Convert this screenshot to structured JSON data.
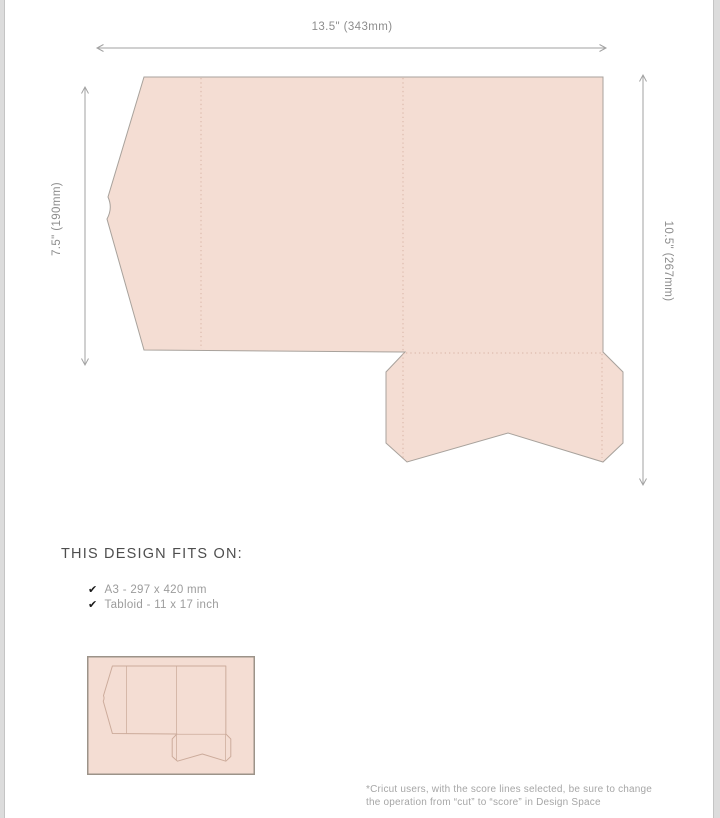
{
  "dimensions": {
    "top": "13.5\" (343mm)",
    "left": "7.5\" (190mm)",
    "right": "10.5\" (267mm)"
  },
  "fits_on": {
    "heading": "THIS DESIGN FITS ON:",
    "checkmark_glyph": "✔",
    "items": [
      {
        "icon": "checkmark",
        "label": "A3 - 297 x 420 mm"
      },
      {
        "icon": "checkmark",
        "label": "Tabloid - 11 x 17 inch"
      }
    ]
  },
  "footnote": {
    "line1": "*Cricut users, with the score lines selected, be sure to change",
    "line2": "the operation from “cut” to “score” in Design Space"
  },
  "colors": {
    "shape-fill": "#f4ddd3",
    "shape-stroke": "#a8a29c",
    "score-line": "#d8b4a5",
    "dim-line": "#a2a2a2",
    "dim-text": "#8d8d8d",
    "heading-text": "#4e4e4e",
    "list-text": "#9c9c9c",
    "check": "#1a1a1a",
    "footnote-text": "#a6a6a6",
    "edge-strip": "#dcdcdc",
    "edge-strip-border": "#c4c4c4",
    "thumb-border": "#9c9389",
    "thumb-stroke": "#ccab9b"
  }
}
